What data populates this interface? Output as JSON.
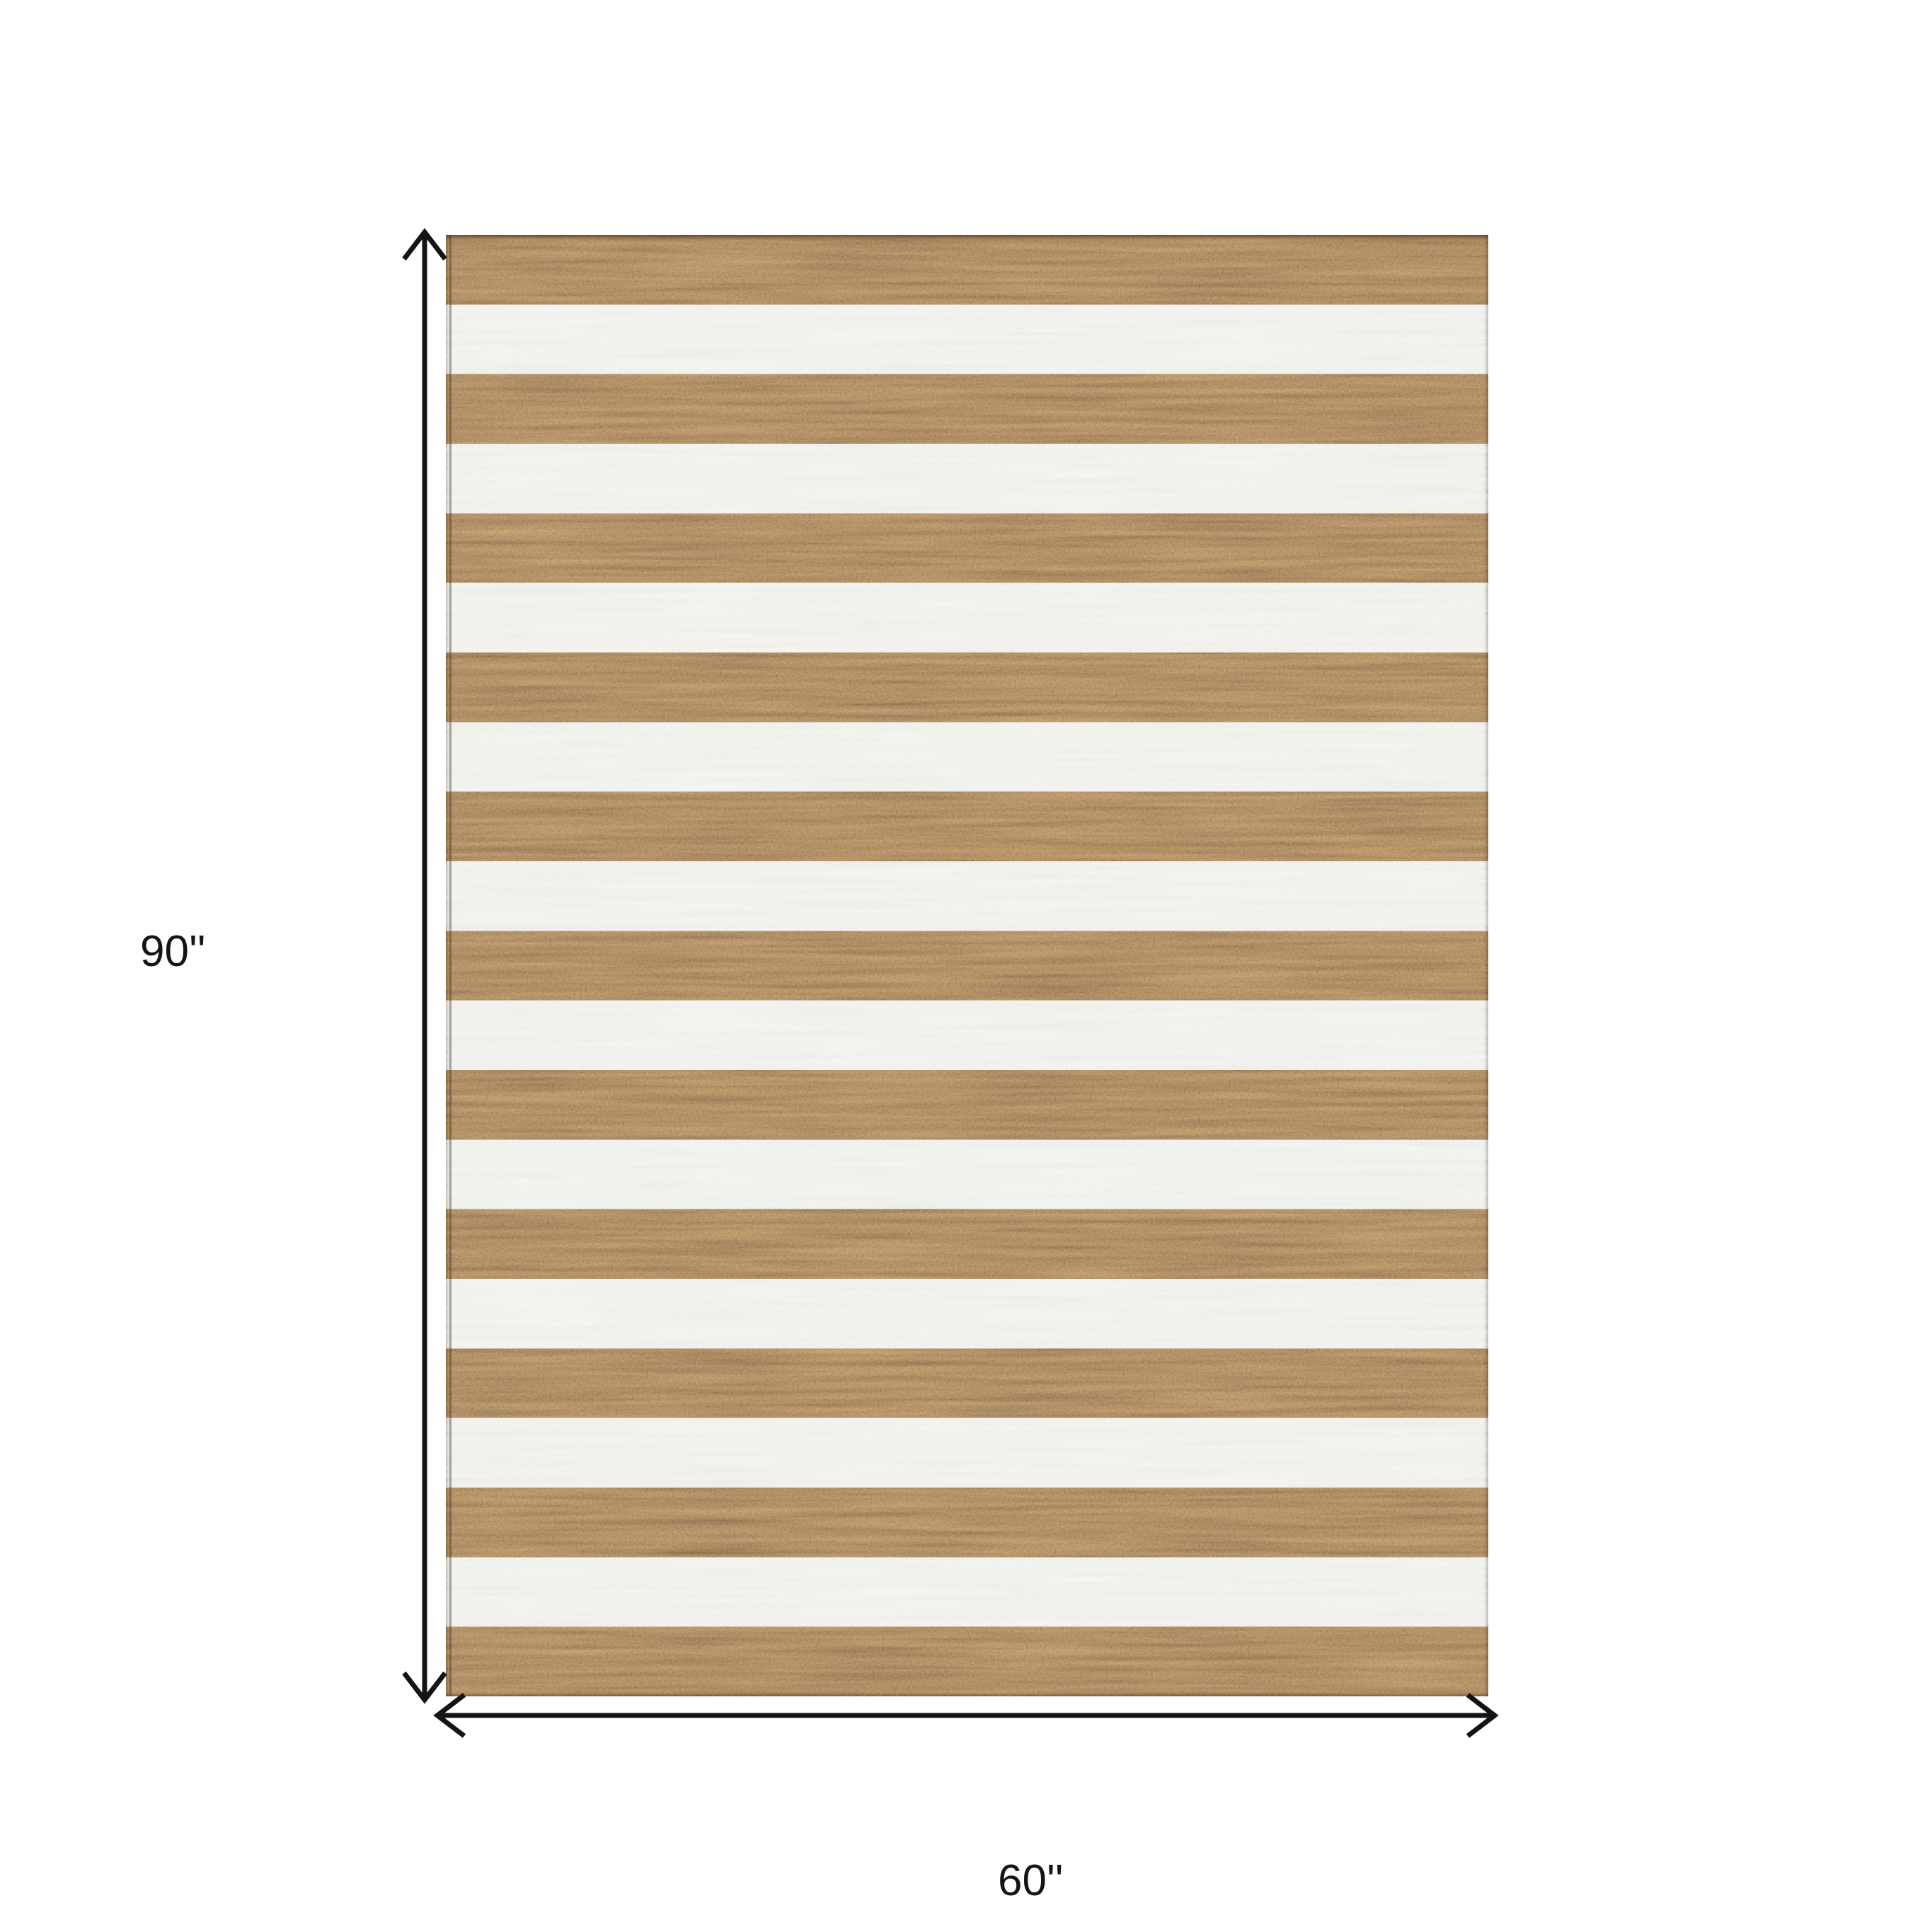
{
  "diagram": {
    "type": "product-dimension-diagram",
    "height_label": "90''",
    "width_label": "60''",
    "rug": {
      "description": "brown and white horizontal striped area rug",
      "stripe_orientation": "horizontal",
      "stripe_count": 21,
      "first_stripe": "brown",
      "last_stripe": "brown",
      "colors": {
        "brown_stripe": "#8a6c4d",
        "white_stripe": "#eaeae6",
        "selvage_edge": "#4a3826"
      }
    },
    "annotation": {
      "arrow_color": "#141414",
      "label_color": "#141414"
    },
    "background_color": "#ffffff"
  }
}
